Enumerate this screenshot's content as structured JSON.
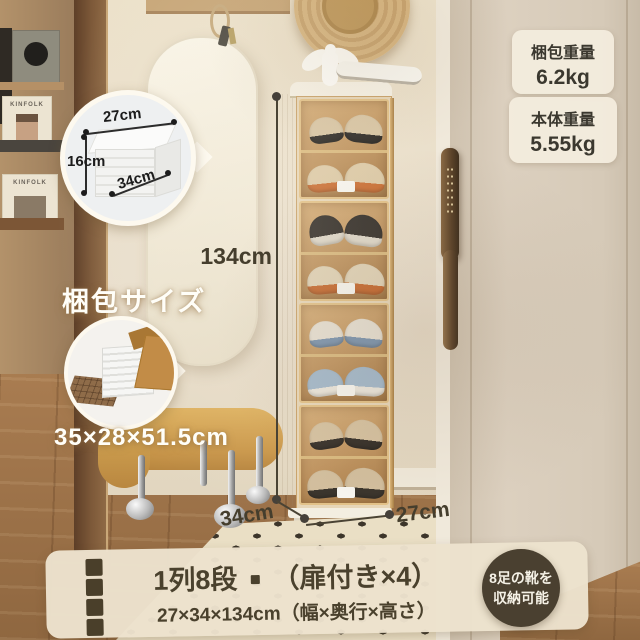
{
  "weight_badges": [
    {
      "label": "梱包重量",
      "value": "6.2kg"
    },
    {
      "label": "本体重量",
      "value": "5.55kg"
    }
  ],
  "box_inset": {
    "width": "27cm",
    "height": "16cm",
    "depth": "34cm"
  },
  "package": {
    "title": "梱包サイズ",
    "size": "35×28×51.5cm"
  },
  "dimensions": {
    "height": "134cm",
    "depth": "34cm",
    "width": "27cm"
  },
  "banner": {
    "title_left": "1列8段",
    "separator": "・",
    "title_right": "（扉付き×4）",
    "subtitle": "27×34×134cm（幅×奥行×高さ）"
  },
  "capacity_badge": {
    "line1": "8足の靴を",
    "line2": "収納可能"
  },
  "decor": {
    "magazine_title_1": "KINFOLK",
    "magazine_title_2": "KINFOLK"
  },
  "colors": {
    "accent_text": "#4a412d",
    "banner_bg": "#ece2cd",
    "badge_bg": "#f3ecdd",
    "capacity_bg": "#4a4030",
    "door_amber": "#c59a62",
    "white_label": "#fffef8"
  }
}
